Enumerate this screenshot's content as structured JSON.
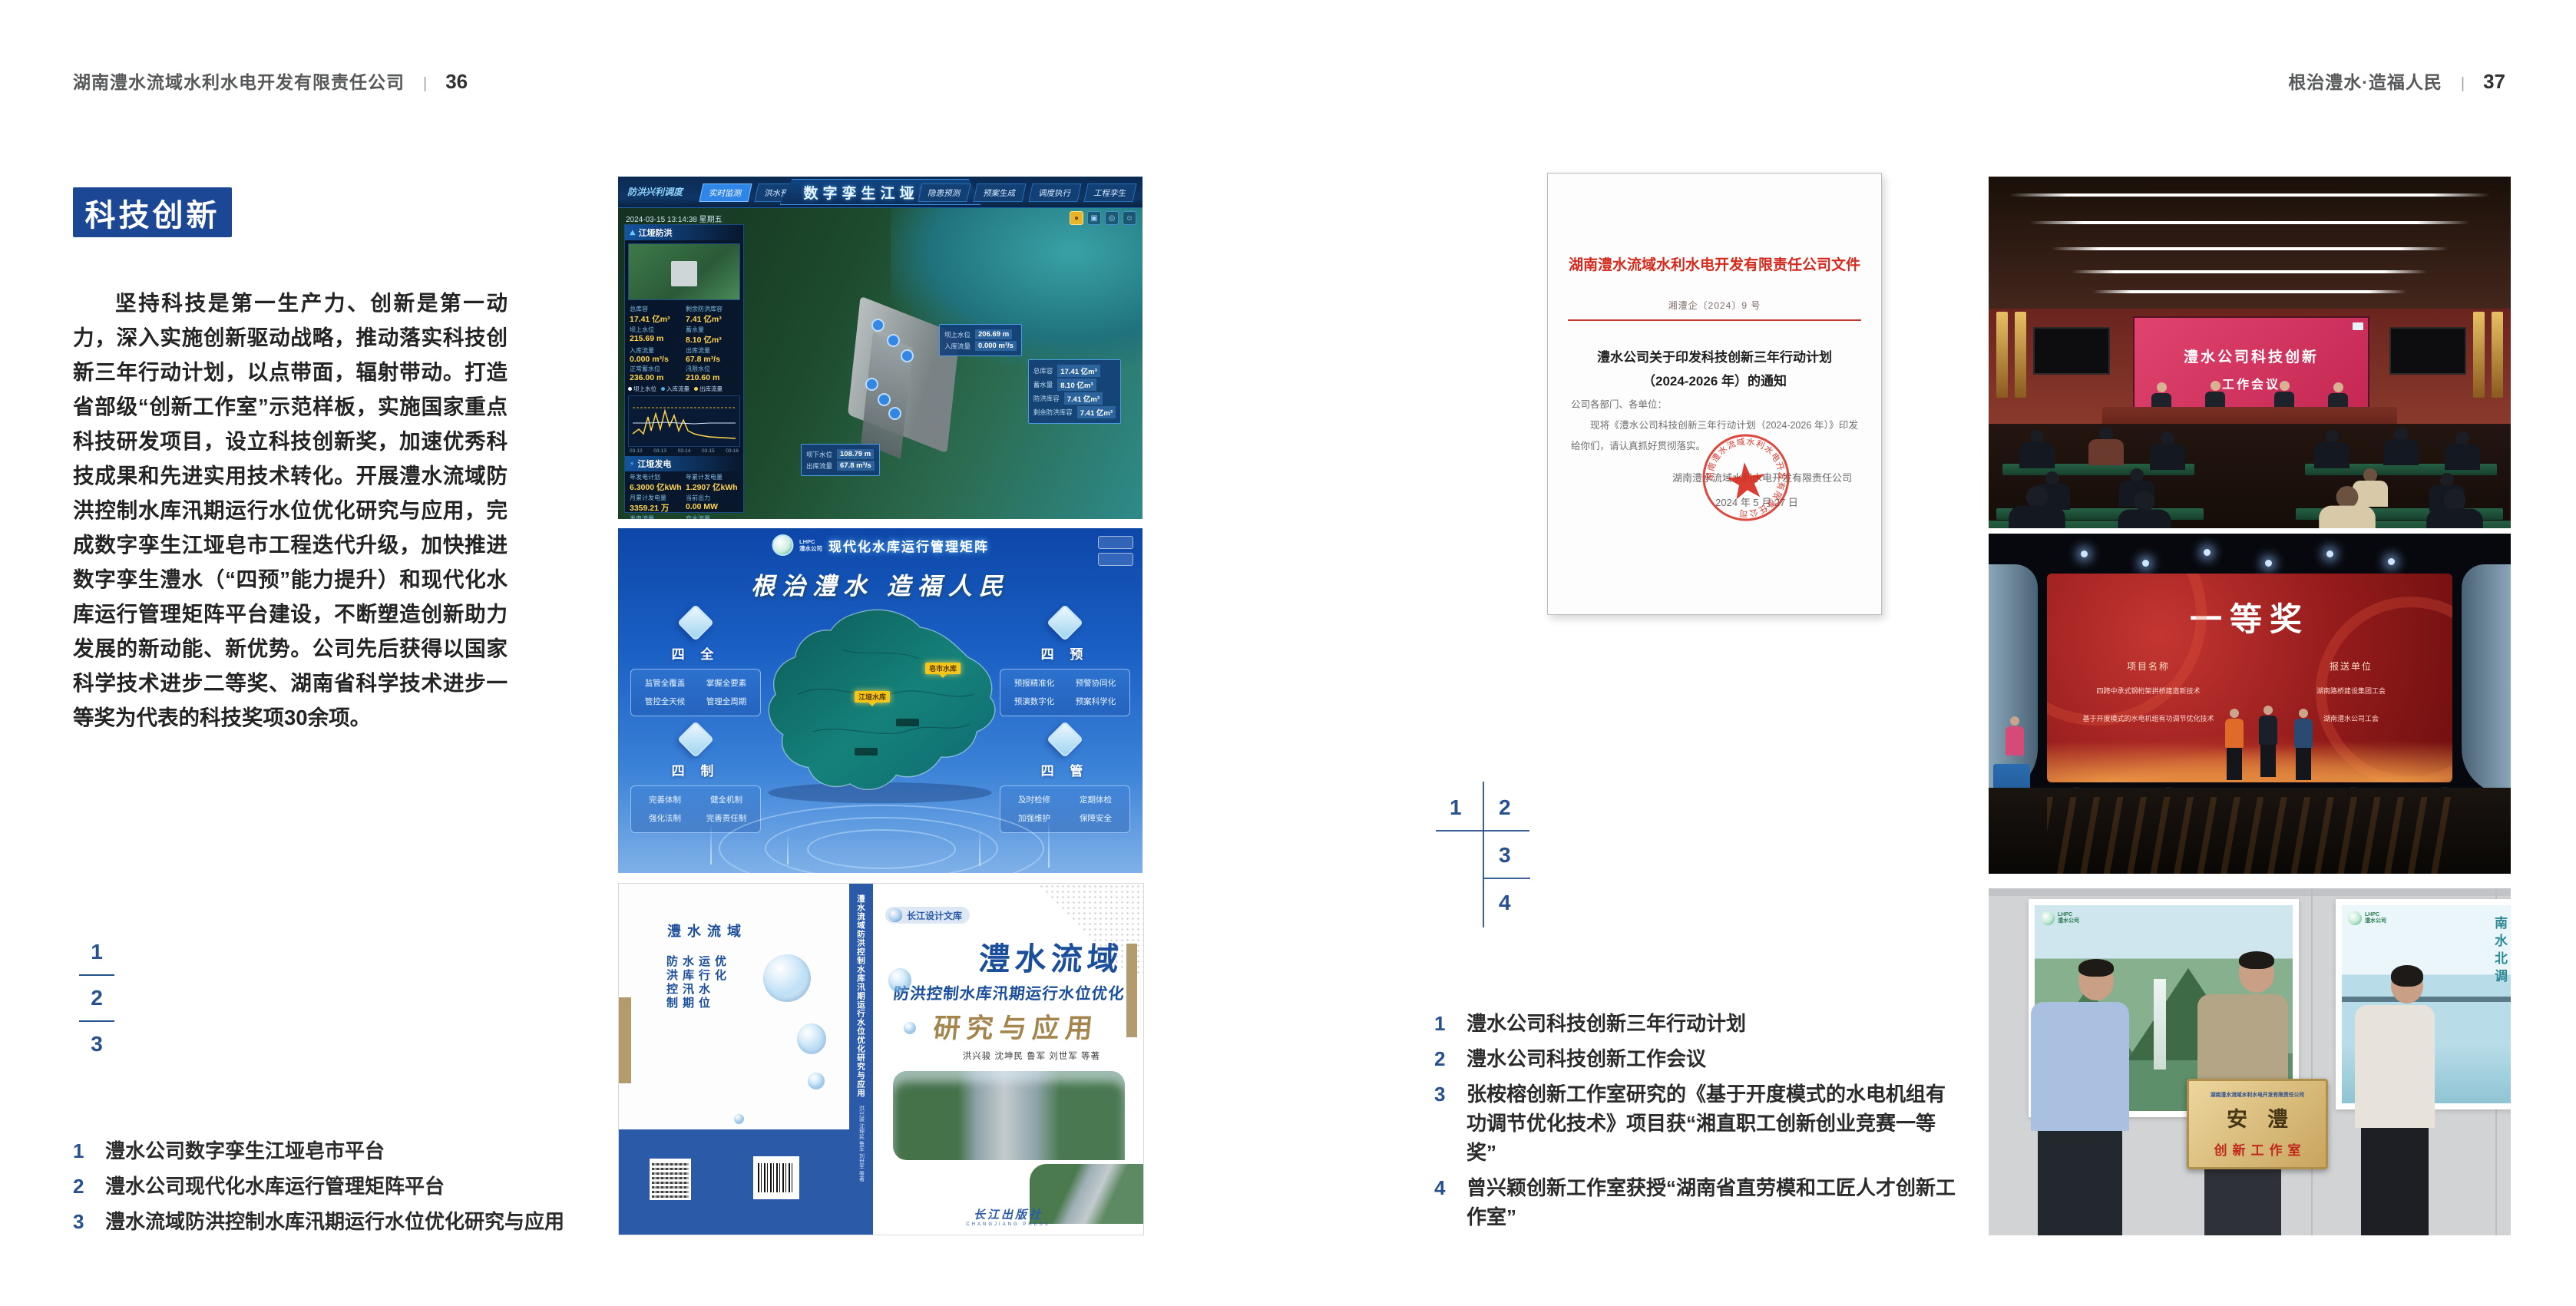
{
  "colors": {
    "accent_blue": "#1c4795",
    "index_blue": "#27508f",
    "doc_red": "#d6291c",
    "book_blue": "#1b4f9b",
    "book_brown": "#a5854e",
    "meeting_screen_pink": "#d23a5e",
    "award_screen_red": "#941b1b",
    "plaque_gold": "#d9b873"
  },
  "left_page": {
    "header": {
      "company": "湖南澧水流域水利水电开发有限责任公司",
      "divider": "|",
      "page_no": "36"
    },
    "section_title": "科技创新",
    "paragraph": "坚持科技是第一生产力、创新是第一动力，深入实施创新驱动战略，推动落实科技创新三年行动计划，以点带面，辐射带动。打造省部级“创新工作室”示范样板，实施国家重点科技研发项目，设立科技创新奖，加速优秀科技成果和先进实用技术转化。开展澧水流域防洪控制水库汛期运行水位优化研究与应用，完成数字孪生江垭皂市工程迭代升级，加快推进数字孪生澧水（“四预”能力提升）和现代化水库运行管理矩阵平台建设，不断塑造创新助力发展的新动能、新优势。公司先后获得以国家科学技术进步二等奖、湖南省科学技术进步一等奖为代表的科技奖项30余项。",
    "figure_index": {
      "n1": "1",
      "n2": "2",
      "n3": "3"
    },
    "captions": [
      {
        "no": "1",
        "text": "澧水公司数字孪生江垭皂市平台"
      },
      {
        "no": "2",
        "text": "澧水公司现代化水库运行管理矩阵平台"
      },
      {
        "no": "3",
        "text": "澧水流域防洪控制水库汛期运行水位优化研究与应用"
      }
    ]
  },
  "right_page": {
    "header": {
      "slogan": "根治澧水·造福人民",
      "divider": "|",
      "page_no": "37"
    },
    "figure_index": {
      "n1": "1",
      "n2": "2",
      "n3": "3",
      "n4": "4"
    },
    "captions": [
      {
        "no": "1",
        "text": "澧水公司科技创新三年行动计划"
      },
      {
        "no": "2",
        "text": "澧水公司科技创新工作会议"
      },
      {
        "no": "3",
        "text": "张桉榕创新工作室研究的《基于开度模式的水电机组有功调节优化技术》项目获“湘直职工创新创业竞赛一等奖”"
      },
      {
        "no": "4",
        "text": "曾兴颖创新工作室获授“湖南省直劳模和工匠人才创新工作室”"
      }
    ]
  },
  "dashboard_twin": {
    "module_label": "防洪兴利调度",
    "title": "数字孪生江垭皂市",
    "tabs_left": [
      "实时监测",
      "洪水预报",
      "防洪预警"
    ],
    "tabs_right": [
      "隐患预测",
      "预案生成",
      "调度执行",
      "工程孪生"
    ],
    "timestamp": "2024-03-15 13:14:38 星期五",
    "panel_flood": {
      "title": "江垭防洪",
      "stats": [
        [
          "总库容",
          "17.41 亿m³"
        ],
        [
          "剩余防洪库容",
          "7.41 亿m³"
        ],
        [
          "坝上水位",
          "215.69 m"
        ],
        [
          "蓄水量",
          "8.10 亿m³"
        ],
        [
          "入库流量",
          "0.000 m³/s"
        ],
        [
          "出库流量",
          "67.8 m³/s"
        ],
        [
          "正常蓄水位",
          "236.00 m"
        ],
        [
          "汛限水位",
          "210.60 m"
        ]
      ],
      "legend": [
        "坝上水位",
        "入库流量",
        "出库流量"
      ],
      "x_labels": [
        "03-12",
        "03-13",
        "03-14",
        "03-15",
        "03-16"
      ]
    },
    "panel_power": {
      "title": "江垭发电",
      "stats": [
        [
          "年发电计划",
          "6.3000 亿kWh"
        ],
        [
          "年累计发电量",
          "1.2907 亿kWh"
        ],
        [
          "月累计发电量",
          "3359.21 万"
        ],
        [
          "当前出力",
          "0.00 MW"
        ],
        [
          "发电流量",
          "0.00 m³/s"
        ],
        [
          "弃水流量",
          "0.00 m³/s"
        ]
      ],
      "units": [
        "1#机组",
        "2#机组",
        "3#机组"
      ]
    },
    "chip_upper": {
      "rows": [
        [
          "坝上水位",
          "206.69 m"
        ],
        [
          "入库流量",
          "0.000 m³/s"
        ]
      ]
    },
    "chip_right": {
      "rows": [
        [
          "总库容",
          "17.41 亿m³"
        ],
        [
          "蓄水量",
          "8.10 亿m³"
        ],
        [
          "防洪库容",
          "7.41 亿m³"
        ],
        [
          "剩余防洪库容",
          "7.41 亿m³"
        ]
      ]
    },
    "chip_lower": {
      "rows": [
        [
          "坝下水位",
          "108.79 m"
        ],
        [
          "出库流量",
          "67.8 m³/s"
        ]
      ]
    }
  },
  "dashboard_matrix": {
    "logo": "LHPC",
    "logo_sub": "澧水公司",
    "title": "现代化水库运行管理矩阵",
    "slogan": "根治澧水 造福人民",
    "groups": [
      {
        "name": "四 全",
        "items": [
          "监管全覆盖",
          "掌握全要素",
          "管控全天候",
          "管理全周期"
        ]
      },
      {
        "name": "四 制",
        "items": [
          "完善体制",
          "健全机制",
          "强化法制",
          "完善责任制"
        ]
      },
      {
        "name": "四 预",
        "items": [
          "预报精准化",
          "预警协同化",
          "预演数字化",
          "预案科学化"
        ]
      },
      {
        "name": "四 管",
        "items": [
          "及时检修",
          "定期体检",
          "加强维护",
          "保障安全"
        ]
      }
    ],
    "map_labels": {
      "l1": "江垭水库",
      "l2": "皂市水库"
    }
  },
  "book": {
    "series_badge": "长江设计文库",
    "title_1": "澧水流域",
    "title_2": "防洪控制水库汛期运行水位优化",
    "title_3": "研究与应用",
    "authors": "洪兴骏  沈坤民  鲁军  刘世军  等著",
    "publisher": "长江出版社",
    "publisher_en": "CHANGJIANG PRESS",
    "spine_title": "澧水流域防洪控制水库汛期运行水位优化研究与应用",
    "spine_authors": "洪兴骏 沈坤民 鲁军 刘世军 等著",
    "back_title_1": "澧水流域",
    "back_title_2": "防洪控制水库汛期运行水位优化",
    "back_title_3": "研究与应用"
  },
  "document": {
    "header": "湖南澧水流域水利水电开发有限责任公司文件",
    "doc_no": "湘澧企〔2024〕9 号",
    "title_line1": "澧水公司关于印发科技创新三年行动计划",
    "title_line2": "（2024-2026 年）的通知",
    "salutation": "公司各部门、各单位：",
    "body": "现将《澧水公司科技创新三年行动计划（2024-2026 年）》印发给你们，请认真抓好贯彻落实。",
    "signer": "湖南澧水流域水利水电开发有限责任公司",
    "date": "2024 年 5 月 27 日",
    "seal_text": "湖南澧水流域水利水电开发有限责任公司"
  },
  "photo_meeting": {
    "screen_line1": "澧水公司科技创新",
    "screen_line2": "工作会议"
  },
  "photo_award": {
    "screen_title": "一等奖",
    "col1": "项目名称",
    "col2": "报送单位",
    "rows": [
      [
        "四跨中承式钢桁架拱桥建造新技术",
        "湖南路桥建设集团工会"
      ],
      [
        "基于开度模式的水电机组有功调节优化技术",
        "湖南澧水公司工会"
      ]
    ]
  },
  "photo_plaque": {
    "plaque_company": "湖南澧水流域水利水电开发有限责任公司",
    "plaque_name": "安澧",
    "plaque_title": "创新工作室",
    "poster_right_text": "南水北调"
  }
}
